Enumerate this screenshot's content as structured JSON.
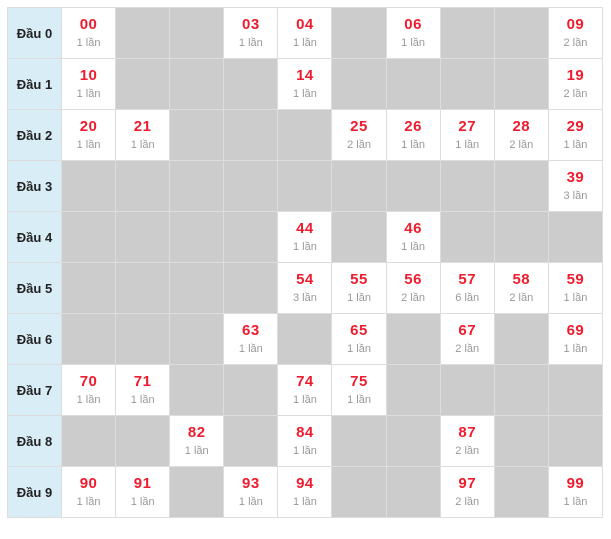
{
  "colors": {
    "label_bg": "#d9edf7",
    "label_text": "#222222",
    "empty_bg": "#cccccc",
    "border": "#dddddd",
    "number_red": "#ee1c2e",
    "count_gray": "#999999",
    "cell_bg": "#ffffff"
  },
  "grid": {
    "count_unit": "lần",
    "column_digits": [
      "0",
      "1",
      "2",
      "3",
      "4",
      "5",
      "6",
      "7",
      "8",
      "9"
    ],
    "rows": [
      {
        "label": "Đầu 0",
        "cells": [
          {
            "n": "00",
            "c": "1 lần"
          },
          null,
          null,
          {
            "n": "03",
            "c": "1 lần"
          },
          {
            "n": "04",
            "c": "1 lần"
          },
          null,
          {
            "n": "06",
            "c": "1 lần"
          },
          null,
          null,
          {
            "n": "09",
            "c": "2 lần"
          }
        ]
      },
      {
        "label": "Đầu 1",
        "cells": [
          {
            "n": "10",
            "c": "1 lần"
          },
          null,
          null,
          null,
          {
            "n": "14",
            "c": "1 lần"
          },
          null,
          null,
          null,
          null,
          {
            "n": "19",
            "c": "2 lần"
          }
        ]
      },
      {
        "label": "Đầu 2",
        "cells": [
          {
            "n": "20",
            "c": "1 lần"
          },
          {
            "n": "21",
            "c": "1 lần"
          },
          null,
          null,
          null,
          {
            "n": "25",
            "c": "2 lần"
          },
          {
            "n": "26",
            "c": "1 lần"
          },
          {
            "n": "27",
            "c": "1 lần"
          },
          {
            "n": "28",
            "c": "2 lần"
          },
          {
            "n": "29",
            "c": "1 lần"
          }
        ]
      },
      {
        "label": "Đầu 3",
        "cells": [
          null,
          null,
          null,
          null,
          null,
          null,
          null,
          null,
          null,
          {
            "n": "39",
            "c": "3 lần"
          }
        ]
      },
      {
        "label": "Đầu 4",
        "cells": [
          null,
          null,
          null,
          null,
          {
            "n": "44",
            "c": "1 lần"
          },
          null,
          {
            "n": "46",
            "c": "1 lần"
          },
          null,
          null,
          null
        ]
      },
      {
        "label": "Đầu 5",
        "cells": [
          null,
          null,
          null,
          null,
          {
            "n": "54",
            "c": "3 lần"
          },
          {
            "n": "55",
            "c": "1 lần"
          },
          {
            "n": "56",
            "c": "2 lần"
          },
          {
            "n": "57",
            "c": "6 lần"
          },
          {
            "n": "58",
            "c": "2 lần"
          },
          {
            "n": "59",
            "c": "1 lần"
          }
        ]
      },
      {
        "label": "Đầu 6",
        "cells": [
          null,
          null,
          null,
          {
            "n": "63",
            "c": "1 lần"
          },
          null,
          {
            "n": "65",
            "c": "1 lần"
          },
          null,
          {
            "n": "67",
            "c": "2 lần"
          },
          null,
          {
            "n": "69",
            "c": "1 lần"
          }
        ]
      },
      {
        "label": "Đầu 7",
        "cells": [
          {
            "n": "70",
            "c": "1 lần"
          },
          {
            "n": "71",
            "c": "1 lần"
          },
          null,
          null,
          {
            "n": "74",
            "c": "1 lần"
          },
          {
            "n": "75",
            "c": "1 lần"
          },
          null,
          null,
          null,
          null
        ]
      },
      {
        "label": "Đầu 8",
        "cells": [
          null,
          null,
          {
            "n": "82",
            "c": "1 lần"
          },
          null,
          {
            "n": "84",
            "c": "1 lần"
          },
          null,
          null,
          {
            "n": "87",
            "c": "2 lần"
          },
          null,
          null
        ]
      },
      {
        "label": "Đầu 9",
        "cells": [
          {
            "n": "90",
            "c": "1 lần"
          },
          {
            "n": "91",
            "c": "1 lần"
          },
          null,
          {
            "n": "93",
            "c": "1 lần"
          },
          {
            "n": "94",
            "c": "1 lần"
          },
          null,
          null,
          {
            "n": "97",
            "c": "2 lần"
          },
          null,
          {
            "n": "99",
            "c": "1 lần"
          }
        ]
      }
    ]
  },
  "chart_data": {
    "type": "table",
    "title": "",
    "unit": "lần",
    "row_headers": [
      "Đầu 0",
      "Đầu 1",
      "Đầu 2",
      "Đầu 3",
      "Đầu 4",
      "Đầu 5",
      "Đầu 6",
      "Đầu 7",
      "Đầu 8",
      "Đầu 9"
    ],
    "col_headers": [
      "0",
      "1",
      "2",
      "3",
      "4",
      "5",
      "6",
      "7",
      "8",
      "9"
    ],
    "counts_matrix": [
      [
        1,
        null,
        null,
        1,
        1,
        null,
        1,
        null,
        null,
        2
      ],
      [
        1,
        null,
        null,
        null,
        1,
        null,
        null,
        null,
        null,
        2
      ],
      [
        1,
        1,
        null,
        null,
        null,
        2,
        1,
        1,
        2,
        1
      ],
      [
        null,
        null,
        null,
        null,
        null,
        null,
        null,
        null,
        null,
        3
      ],
      [
        null,
        null,
        null,
        null,
        1,
        null,
        1,
        null,
        null,
        null
      ],
      [
        null,
        null,
        null,
        null,
        3,
        1,
        2,
        6,
        2,
        1
      ],
      [
        null,
        null,
        null,
        1,
        null,
        1,
        null,
        2,
        null,
        1
      ],
      [
        1,
        1,
        null,
        null,
        1,
        1,
        null,
        null,
        null,
        null
      ],
      [
        null,
        null,
        1,
        null,
        1,
        null,
        null,
        2,
        null,
        null
      ],
      [
        1,
        1,
        null,
        1,
        1,
        null,
        null,
        2,
        null,
        1
      ]
    ],
    "frequencies": {
      "00": 1,
      "03": 1,
      "04": 1,
      "06": 1,
      "09": 2,
      "10": 1,
      "14": 1,
      "19": 2,
      "20": 1,
      "21": 1,
      "25": 2,
      "26": 1,
      "27": 1,
      "28": 2,
      "29": 1,
      "39": 3,
      "44": 1,
      "46": 1,
      "54": 3,
      "55": 1,
      "56": 2,
      "57": 6,
      "58": 2,
      "59": 1,
      "63": 1,
      "65": 1,
      "67": 2,
      "69": 1,
      "70": 1,
      "71": 1,
      "74": 1,
      "75": 1,
      "82": 1,
      "84": 1,
      "87": 2,
      "90": 1,
      "91": 1,
      "93": 1,
      "94": 1,
      "97": 2,
      "99": 1
    }
  }
}
